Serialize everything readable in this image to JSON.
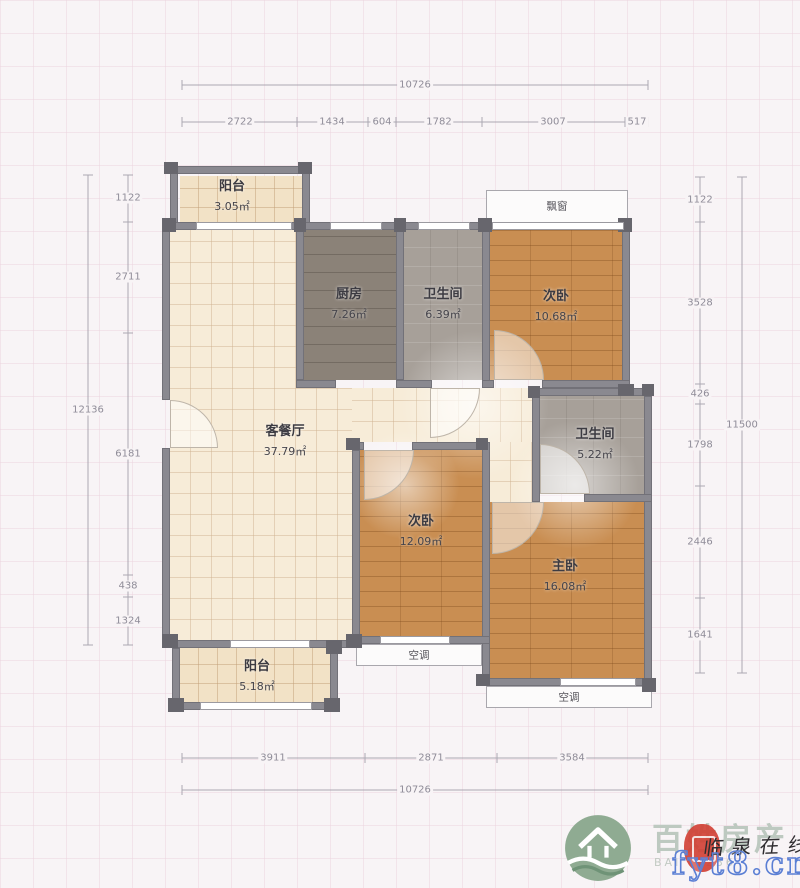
{
  "plan": {
    "rooms": [
      {
        "name": "阳台",
        "area": "3.05㎡"
      },
      {
        "name": "厨房",
        "area": "7.26㎡"
      },
      {
        "name": "卫生间",
        "area": "6.39㎡"
      },
      {
        "name": "次卧",
        "area": "10.68㎡"
      },
      {
        "name": "客餐厅",
        "area": "37.79㎡"
      },
      {
        "name": "卫生间",
        "area": "5.22㎡"
      },
      {
        "name": "次卧",
        "area": "12.09㎡"
      },
      {
        "name": "主卧",
        "area": "16.08㎡"
      },
      {
        "name": "阳台",
        "area": "5.18㎡"
      }
    ],
    "features": {
      "bay_window": "飘窗",
      "ac_left": "空调",
      "ac_right": "空调"
    }
  },
  "dimensions": {
    "top": {
      "total": "10726",
      "segments": [
        "2722",
        "1434",
        "604",
        "1782",
        "3007",
        "517"
      ]
    },
    "bottom": {
      "total": "10726",
      "segments": [
        "3911",
        "2871",
        "3584"
      ]
    },
    "left": {
      "total": "12136",
      "segments": [
        "1122",
        "2711",
        "6181",
        "438",
        "1324"
      ]
    },
    "right": {
      "total": "11500",
      "segments": [
        "1122",
        "3528",
        "426",
        "1798",
        "2446",
        "1641"
      ]
    }
  },
  "watermark": {
    "brand": "百姓房产",
    "brand_sub": "BAI",
    "brand_num": "236",
    "calligraphy": "临泉在线",
    "url": "fyt8.cn"
  },
  "colors": {
    "wall": "#8a8990",
    "tile_floor": "#f7ecd8",
    "wood_floor": "#c98e52",
    "kitchen_floor": "#8b8278",
    "bath_floor": "#a7a099",
    "dimension_text": "#8f8c98",
    "logo_green": "#8fab92",
    "seal_red": "#d23f33",
    "url_blue": "#5b7fd4"
  }
}
